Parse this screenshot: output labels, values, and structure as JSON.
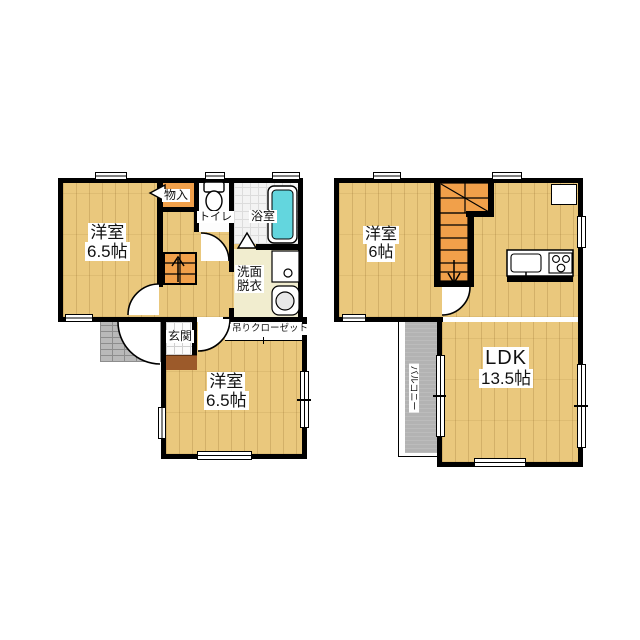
{
  "document": {
    "kind": "japanese-floor-plan",
    "floors": 2
  },
  "colors": {
    "wall": "#000000",
    "wood_floor": "#eac87d",
    "stairs_storage_orange": "#f1a04a",
    "bathtub_teal": "#63d6de",
    "balcony_gray": "#b3b3b3",
    "porch_gray": "#b9b9b9",
    "washroom_cream": "#f1edcf",
    "entrance_step_brown": "#9c5a2a",
    "label_bg": "#ffffff"
  },
  "floor1": {
    "room_a": {
      "name": "洋室",
      "size": "6.5帖"
    },
    "storage": "物入",
    "toilet": "トイレ",
    "bath": "浴室",
    "washroom": {
      "line1": "洗面",
      "line2": "脱衣"
    },
    "entrance": "玄関",
    "hanging_closet": "吊りクローゼット",
    "room_b": {
      "name": "洋室",
      "size": "6.5帖"
    }
  },
  "floor2": {
    "room": {
      "name": "洋室",
      "size": "6帖"
    },
    "ldk": {
      "name": "LDK",
      "size": "13.5帖"
    },
    "balcony": "バルコニー"
  }
}
